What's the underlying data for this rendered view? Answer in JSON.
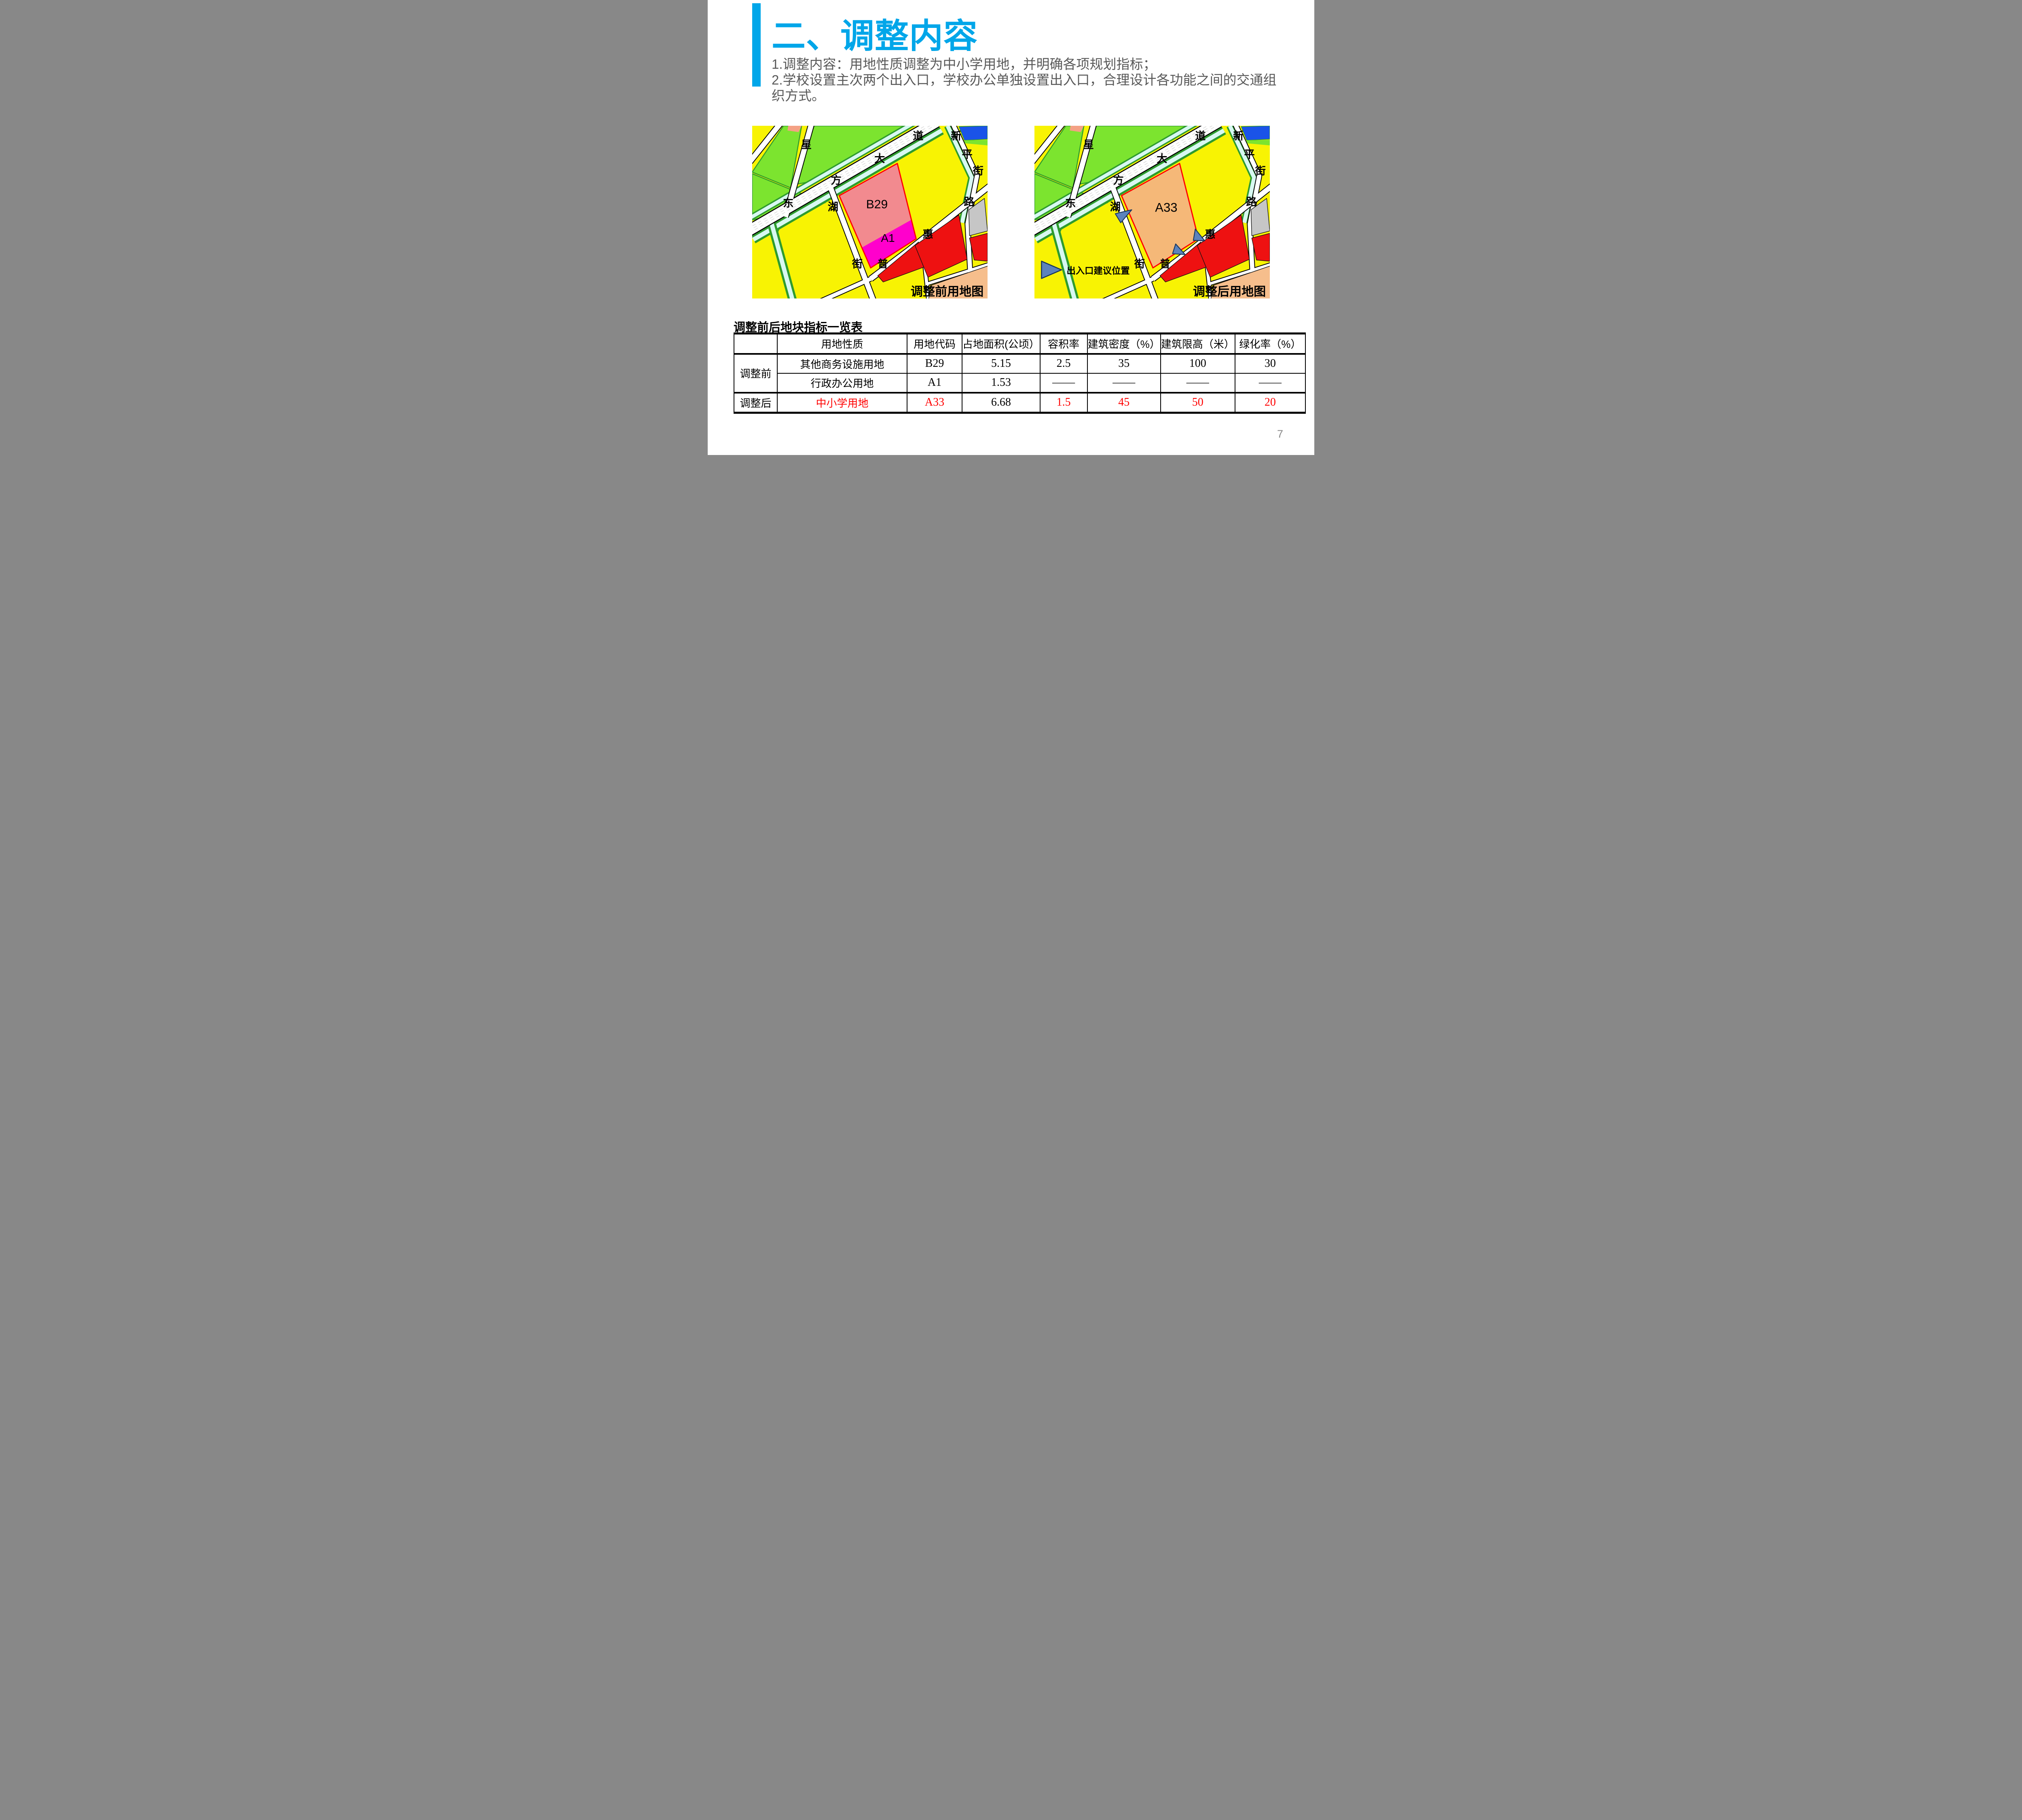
{
  "slide": {
    "title": "二、调整内容",
    "body": [
      "1.调整内容：用地性质调整为中小学用地，并明确各项规划指标；",
      "2.学校设置主次两个出入口，学校办公单独设置出入口，合理设计各功能之间的交通组织方式。"
    ],
    "page_number": "7"
  },
  "colors": {
    "accent": "#00A6E9",
    "body_text": "#595959",
    "highlight_red": "#FF0000",
    "page_number_gray": "#898989"
  },
  "maps": {
    "street_chars": [
      "星",
      "道",
      "大",
      "方",
      "东",
      "湖",
      "街",
      "普",
      "惠",
      "路",
      "新",
      "平",
      "街"
    ],
    "palette": {
      "yellow": "#F8F303",
      "green": "#7CE42F",
      "green_dark": "#2E9B2E",
      "water": "#D8F8F2",
      "road": "#FFFFFF",
      "outline": "#000000",
      "pink": "#F28A8F",
      "magenta": "#FF00CC",
      "orange": "#F5B878",
      "red": "#EE1111",
      "gray": "#C6C6C6",
      "blue": "#1A53E8",
      "salmon": "#F4A184",
      "orange_light": "#F6BE8C",
      "marker_fill": "#5C83BC",
      "marker_stroke": "#17365D",
      "parcel_stroke_red": "#FF0000"
    },
    "before": {
      "caption": "调整前用地图",
      "parcel_labels": [
        "B29",
        "A1"
      ]
    },
    "after": {
      "caption": "调整后用地图",
      "parcel_labels": [
        "A33"
      ],
      "legend_label": "出入口建议位置"
    }
  },
  "table": {
    "title": "调整前后地块指标一览表",
    "headers": [
      "",
      "用地性质",
      "用地代码",
      "占地面积(公顷）",
      "容积率",
      "建筑密度（%）",
      "建筑限高（米）",
      "绿化率（%）"
    ],
    "groups": [
      {
        "label": "调整前",
        "span": 2
      },
      {
        "label": "调整后",
        "span": 1
      }
    ],
    "rows": [
      {
        "cells": [
          "其他商务设施用地",
          "B29",
          "5.15",
          "2.5",
          "35",
          "100",
          "30"
        ],
        "red": []
      },
      {
        "cells": [
          "行政办公用地",
          "A1",
          "1.53",
          "——",
          "——",
          "——",
          "——"
        ],
        "red": []
      },
      {
        "cells": [
          "中小学用地",
          "A33",
          "6.68",
          "1.5",
          "45",
          "50",
          "20"
        ],
        "red": [
          0,
          1,
          3,
          4,
          5,
          6
        ]
      }
    ]
  }
}
